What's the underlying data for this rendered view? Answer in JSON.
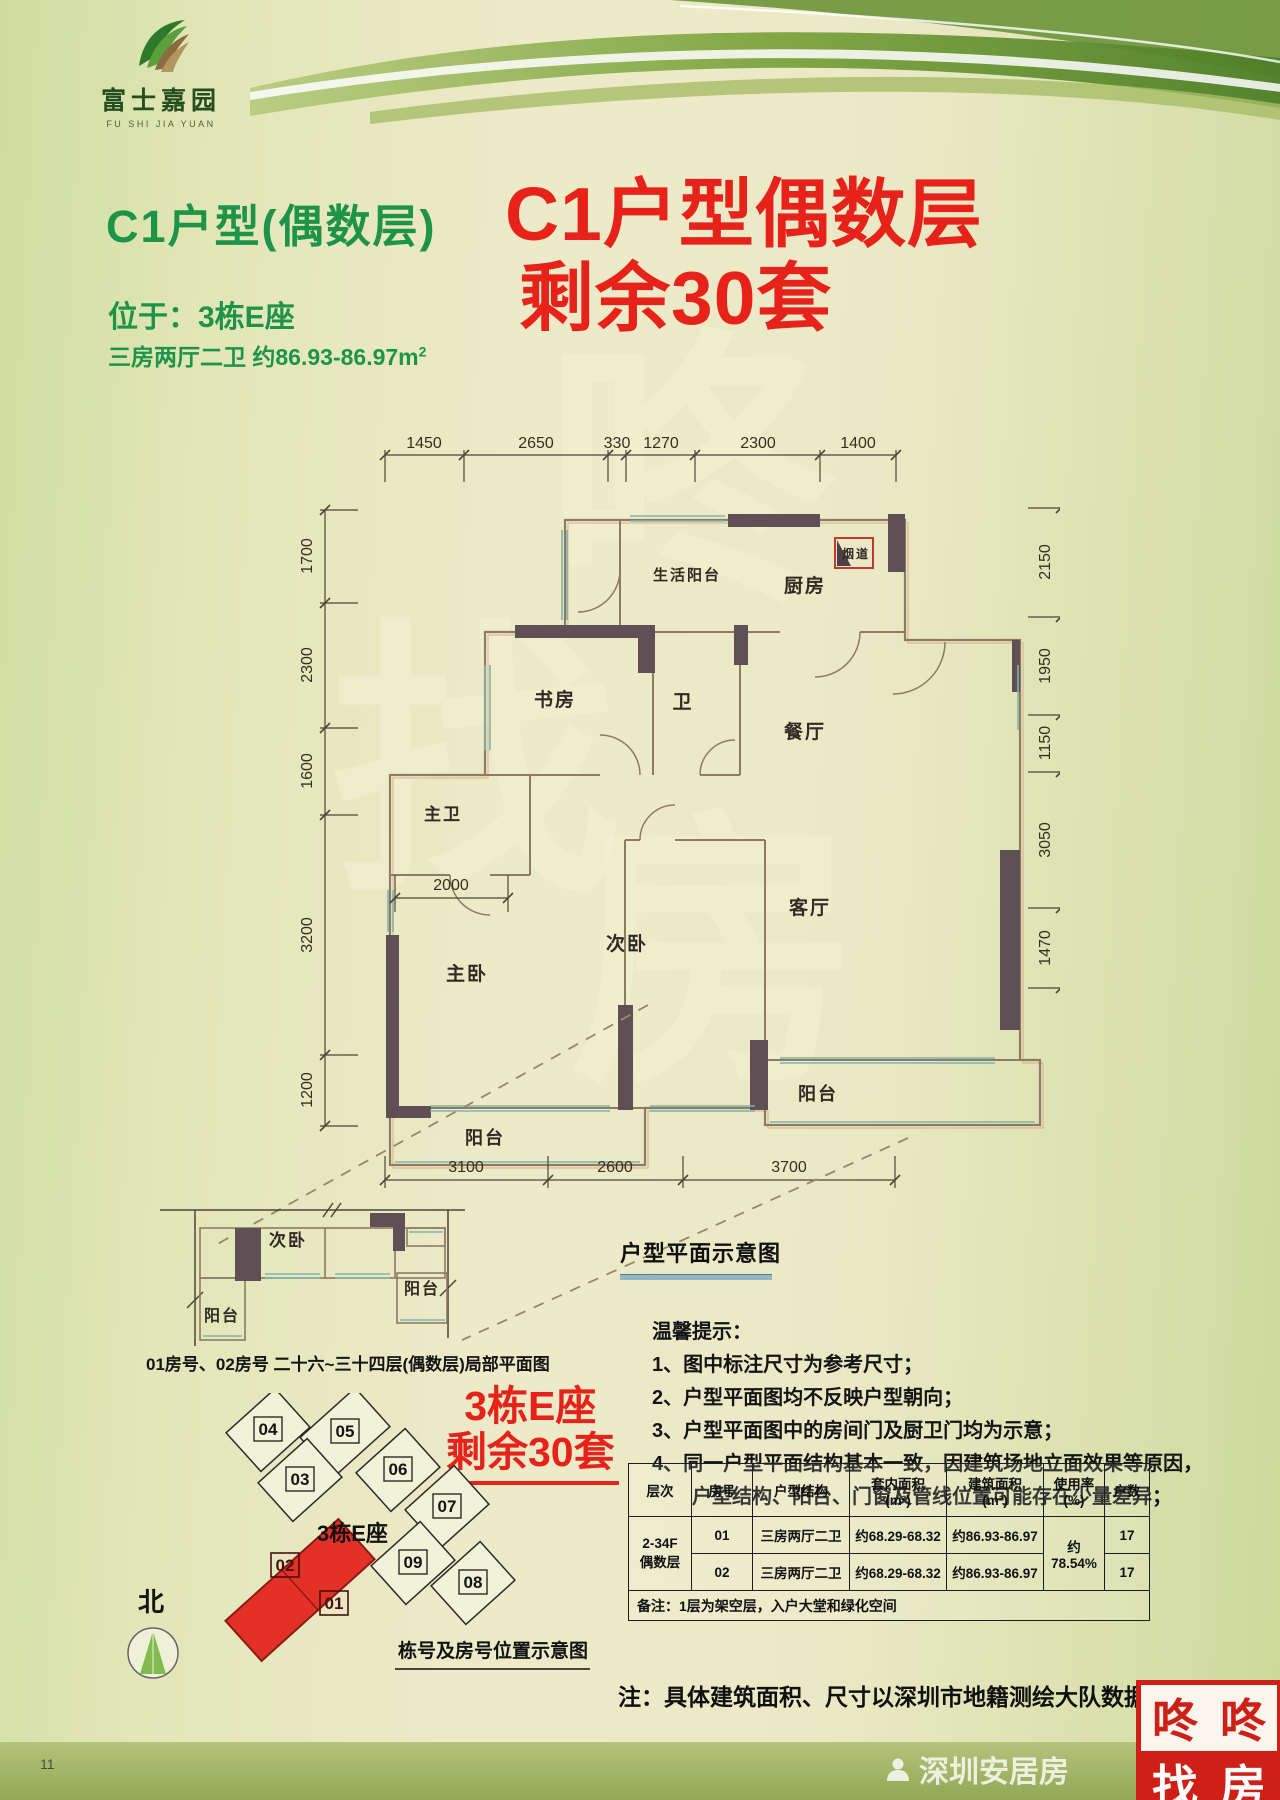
{
  "page": {
    "number": "11"
  },
  "logo": {
    "name": "富士嘉园",
    "sub": "FU SHI JIA YUAN"
  },
  "header": {
    "title": "C1户型(偶数层)",
    "location": "位于：3栋E座",
    "spec": "三房两厅二卫  约86.93-86.97m",
    "spec_sup": "2",
    "promo_line1": "C1户型偶数层",
    "promo_line2": "剩余30套"
  },
  "colors": {
    "brand_green": "#1e9447",
    "promo_red": "#e7221b",
    "stamp_red": "#cf2018",
    "wall_dark": "#5f5055",
    "window_teal": "#7fb4ac"
  },
  "floorplan": {
    "caption": "户型平面示意图",
    "dims_top": [
      "1450",
      "2650",
      "330",
      "1270",
      "2300",
      "1400"
    ],
    "dims_left": [
      "1700",
      "2300",
      "1600",
      "3200",
      "1200"
    ],
    "dims_right": [
      "2150",
      "1950",
      "1150",
      "3050",
      "1470"
    ],
    "dims_bottom": [
      "3100",
      "2600",
      "3700"
    ],
    "dim_inner": "2000",
    "rooms": {
      "service_balcony": "生活阳台",
      "kitchen": "厨房",
      "flue": "烟道",
      "study": "书房",
      "bath": "卫",
      "dining": "餐厅",
      "master_bath": "主卫",
      "master_bedroom": "主卧",
      "second_bedroom": "次卧",
      "living": "客厅",
      "balcony_left": "阳台",
      "balcony_right": "阳台"
    }
  },
  "local_plan": {
    "room_second_bedroom": "次卧",
    "room_balcony_left": "阳台",
    "room_balcony_right": "阳台",
    "caption": "01房号、02房号  二十六~三十四层(偶数层)局部平面图"
  },
  "site": {
    "promo_line1": "3栋E座",
    "promo_line2": "剩余30套",
    "building_label": "3栋E座",
    "blocks": [
      "04",
      "05",
      "03",
      "06",
      "07",
      "09",
      "08"
    ],
    "unit_02": "02",
    "unit_01": "01",
    "north_label": "北",
    "caption": "栋号及房号位置示意图"
  },
  "tips": {
    "title": "温馨提示：",
    "items": [
      "1、图中标注尺寸为参考尺寸；",
      "2、户型平面图均不反映户型朝向；",
      "3、户型平面图中的房间门及厨卫门均为示意；",
      "4、同一户型平面结构基本一致，因建筑场地立面效果等原因，",
      "户型结构、阳台、门窗及管线位置可能存在少量差异；"
    ]
  },
  "table": {
    "headers": [
      {
        "l1": "层次",
        "l2": ""
      },
      {
        "l1": "房号",
        "l2": ""
      },
      {
        "l1": "户型结构",
        "l2": ""
      },
      {
        "l1": "套内面积",
        "l2": "(m²)"
      },
      {
        "l1": "建筑面积",
        "l2": "(m²)"
      },
      {
        "l1": "使用率",
        "l2": "(%)"
      },
      {
        "l1": "户数",
        "l2": ""
      }
    ],
    "floor_l1": "2-34F",
    "floor_l2": "偶数层",
    "usage_rate": "约78.54%",
    "rows": [
      {
        "room": "01",
        "layout": "三房两厅二卫",
        "inner": "约68.29-68.32",
        "built": "约86.93-86.97",
        "count": "17"
      },
      {
        "room": "02",
        "layout": "三房两厅二卫",
        "inner": "约68.29-68.32",
        "built": "约86.93-86.97",
        "count": "17"
      }
    ],
    "remark": "备注：1层为架空层，入户大堂和绿化空间"
  },
  "footnote": "注：具体建筑面积、尺寸以深圳市地籍测绘大队数据为准",
  "stamp": {
    "c1": "咚",
    "c2": "咚",
    "c3": "找",
    "c4": "房"
  },
  "watermark": {
    "text": "深圳安居房",
    "big_chars": [
      "咚",
      "找",
      "房"
    ]
  }
}
